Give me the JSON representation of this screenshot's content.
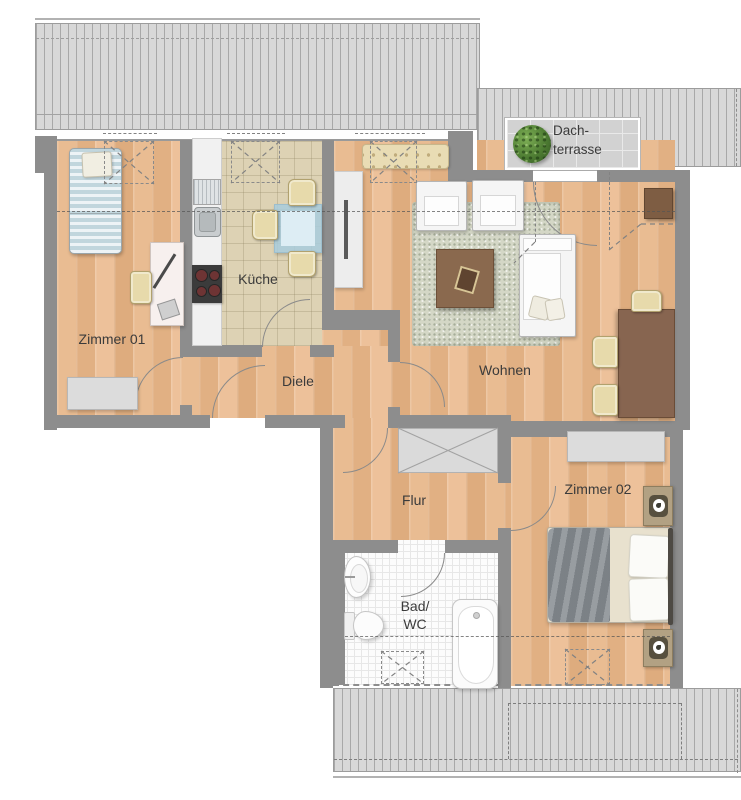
{
  "plan": {
    "title": "apartment-floor-plan",
    "labels": {
      "zimmer01": "Zimmer 01",
      "kueche": "Küche",
      "diele": "Diele",
      "wohnen": "Wohnen",
      "flur": "Flur",
      "zimmer02": "Zimmer 02",
      "bad_line1": "Bad/",
      "bad_line2": "WC",
      "terrasse_line1": "Dach-",
      "terrasse_line2": "terrasse"
    },
    "colors": {
      "wall": "#8d8d8d",
      "wood_floor": "#e5b489",
      "kitchen_floor": "#ddd2b4",
      "bath_floor": "#fcfcfc",
      "terrace_floor": "#d2d2d2",
      "roof_hatch": "#d8d8d8",
      "rug": "#d4d7c6",
      "wood_furniture": "#8a694e",
      "plant_green": "#4e7d33",
      "bed_blanket_gray": "#878d92",
      "glass_table_blue": "#b9d7e4"
    },
    "furniture": {
      "zimmer01": [
        "single-bed",
        "desk",
        "desk-chair",
        "sideboard"
      ],
      "kueche": [
        "kitchen-counter",
        "drainboard",
        "sink",
        "stove",
        "glass-table",
        "chairs"
      ],
      "wohnen": [
        "sideboard",
        "tufted-bench",
        "armchair-left",
        "armchair-right",
        "rug",
        "coffee-table",
        "sofa",
        "dining-table",
        "dining-chairs",
        "side-table"
      ],
      "zimmer02": [
        "wardrobe",
        "double-bed",
        "nightstand-top",
        "nightstand-bottom"
      ],
      "bad": [
        "washbasin",
        "toilet",
        "bathtub"
      ],
      "flur": [
        "built-in-closet"
      ],
      "dachterrasse": [
        "plant"
      ]
    }
  }
}
